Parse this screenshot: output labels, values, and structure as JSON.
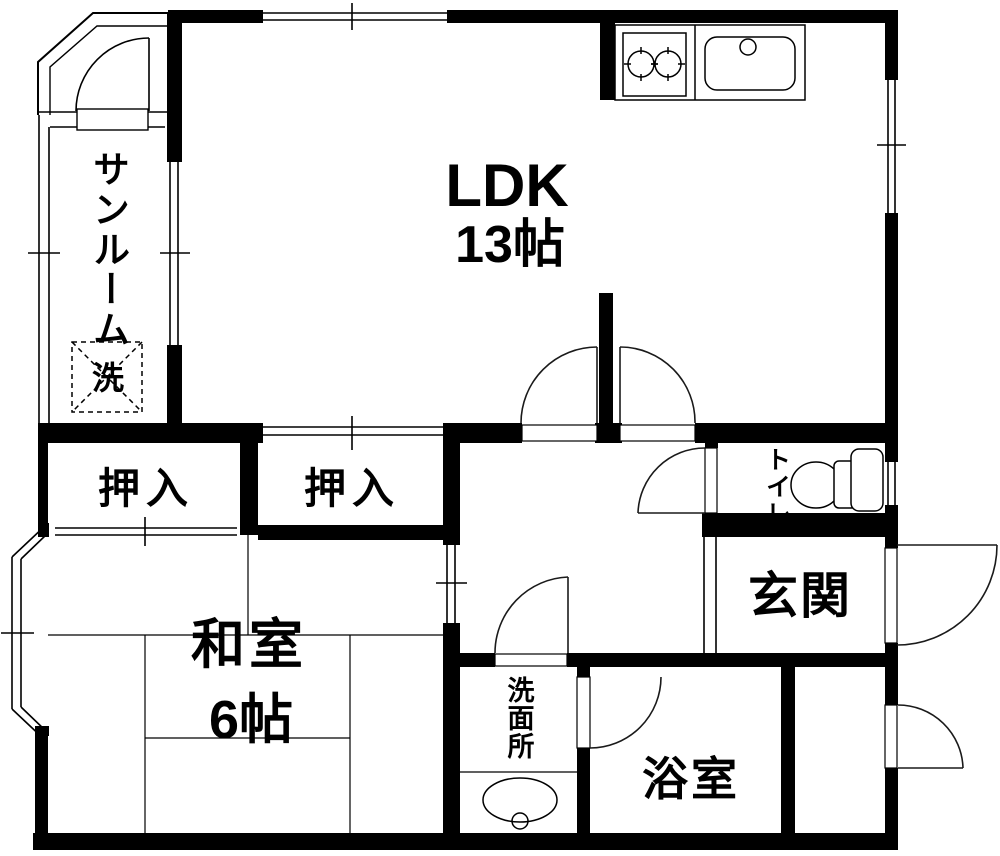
{
  "floorplan": {
    "background": "#ffffff",
    "wall_color": "#000000",
    "rooms": {
      "ldk": {
        "name": "LDK",
        "size": "13帖"
      },
      "sunroom": {
        "name": "サンルーム"
      },
      "washer_box": {
        "label": "洗"
      },
      "closet_left": {
        "name": "押入"
      },
      "closet_right": {
        "name": "押入"
      },
      "japanese_room": {
        "name": "和室",
        "size": "6帖"
      },
      "toilet": {
        "name": "トイレ"
      },
      "entrance": {
        "name": "玄関"
      },
      "washroom": {
        "name": "洗面所"
      },
      "bathroom": {
        "name": "浴室"
      }
    }
  }
}
